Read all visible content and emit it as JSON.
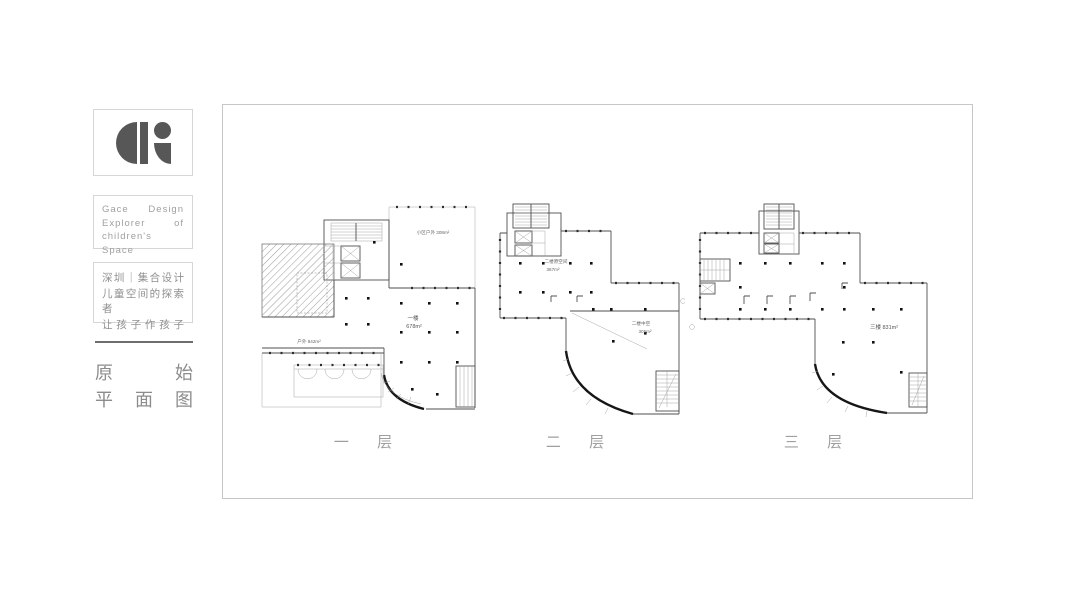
{
  "sidebar": {
    "logo": {
      "icon": "gace-logo",
      "color": "#575757"
    },
    "brand_lines": [
      "Gace Design",
      "Explorer of",
      "children's Space"
    ],
    "studio_lines": [
      "深圳｜集合设计",
      "儿童空间的探索者",
      "让孩子作孩子"
    ],
    "section_title_lines": [
      "原 始",
      "平 面 图"
    ]
  },
  "board": {
    "plans": [
      {
        "caption": "一 层",
        "labels": {
          "outdoor_top": "小区户外 308m²",
          "main_name": "一楼",
          "main_area": "678m²",
          "outdoor_bottom": "户外 842m²"
        }
      },
      {
        "caption": "二 层",
        "labels": {
          "original_name": "二楼原空间",
          "original_area": "367m²",
          "void_name": "二楼中空",
          "void_area": "305m²"
        }
      },
      {
        "caption": "三 层",
        "labels": {
          "main": "三楼 831m²"
        }
      }
    ]
  },
  "colors": {
    "frame_border": "#c6c6c6",
    "box_border": "#d6d6d6",
    "brand_text": "#a0a0a0",
    "studio_text": "#8f8f8f",
    "title_text": "#8c8c8c",
    "caption_text": "#9f9f9f",
    "logo": "#575757"
  }
}
